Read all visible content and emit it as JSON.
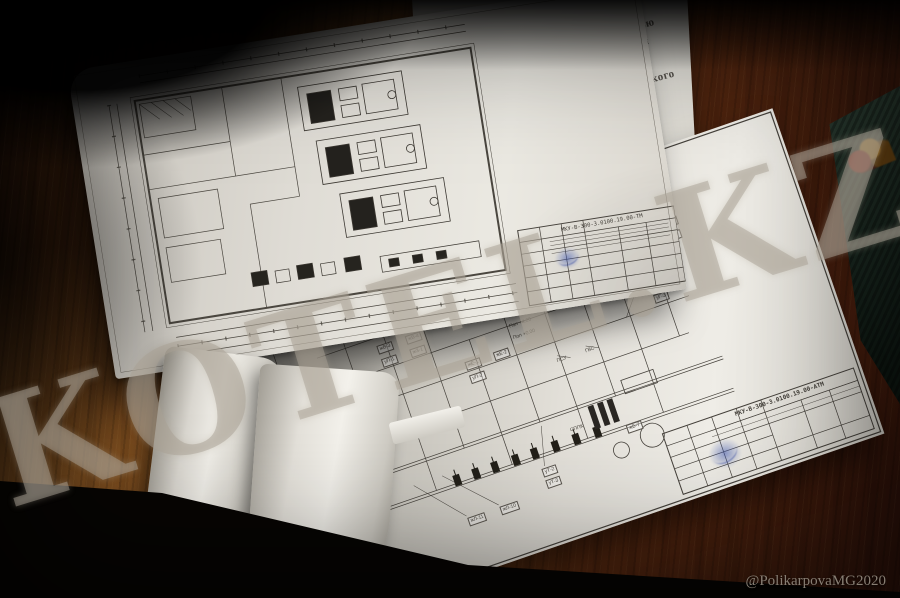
{
  "scene": {
    "watermark_text": "KOTEL.KZ",
    "credit_text": "@PolikarpovaMG2020",
    "colors": {
      "wood_light": "#7b4a1f",
      "wood_dark": "#2e120a",
      "paper": "#dcd9d2",
      "paper_shadow": "#a9a59c",
      "ink": "#45413b",
      "stamp_blue": "#3c55b0",
      "book_green": "#26352c",
      "watermark": "#aaa296"
    }
  },
  "under_page": {
    "fragments": [
      "щностью",
      "танция",
      "нического",
      "ние"
    ]
  },
  "upper_sheet": {
    "code": "МКУ-В-300-3.0100.19.00-ТМ"
  },
  "lower_sheet": {
    "code": "МКУ-В-300-3.0100.19.00-АТМ",
    "labels": [
      {
        "t": "жВ-1",
        "x": 26,
        "y": 148,
        "b": 1
      },
      {
        "t": "жВ-2",
        "x": 56,
        "y": 148,
        "b": 1
      },
      {
        "t": "жН-1",
        "x": 26,
        "y": 162,
        "b": 1
      },
      {
        "t": "жН-2",
        "x": 56,
        "y": 162,
        "b": 1
      },
      {
        "t": "уГ-1",
        "x": 34,
        "y": 190,
        "b": 1
      },
      {
        "t": "уГ-2",
        "x": 64,
        "y": 190,
        "b": 1
      },
      {
        "t": "жГ-3",
        "x": 34,
        "y": 204,
        "b": 1
      },
      {
        "t": "жВ-3",
        "x": 120,
        "y": 96,
        "b": 1
      },
      {
        "t": "жВ-4",
        "x": 150,
        "y": 96,
        "b": 1
      },
      {
        "t": "уП-1",
        "x": 120,
        "y": 110,
        "b": 1
      },
      {
        "t": "жЗ-1",
        "x": 150,
        "y": 110,
        "b": 1
      },
      {
        "t": "жЗ-2",
        "x": 182,
        "y": 74,
        "b": 1
      },
      {
        "t": "уТ-1",
        "x": 212,
        "y": 74,
        "b": 1
      },
      {
        "t": "жЕ-1",
        "x": 198,
        "y": 140,
        "b": 1
      },
      {
        "t": "жЕ-2",
        "x": 228,
        "y": 140,
        "b": 1
      },
      {
        "t": "уП-2",
        "x": 198,
        "y": 154,
        "b": 1
      },
      {
        "t": "Пол +4.20",
        "x": 252,
        "y": 118,
        "b": 0
      },
      {
        "t": "Пол +0.00",
        "x": 252,
        "y": 130,
        "b": 0
      },
      {
        "t": "ПСУ",
        "x": 286,
        "y": 166,
        "b": 0
      },
      {
        "t": "ГВС",
        "x": 316,
        "y": 166,
        "b": 0
      },
      {
        "t": "жЛ-11",
        "x": 150,
        "y": 288,
        "b": 1
      },
      {
        "t": "жЛ-10",
        "x": 184,
        "y": 288,
        "b": 1
      },
      {
        "t": "уТ-2",
        "x": 236,
        "y": 266,
        "b": 1
      },
      {
        "t": "уТ-3",
        "x": 236,
        "y": 278,
        "b": 1
      },
      {
        "t": "СППК",
        "x": 276,
        "y": 236,
        "b": 0
      },
      {
        "t": "жБ-7",
        "x": 330,
        "y": 252,
        "b": 1
      },
      {
        "t": "уП-3",
        "x": 398,
        "y": 96,
        "b": 1
      },
      {
        "t": "жН-3",
        "x": 398,
        "y": 110,
        "b": 1
      },
      {
        "t": "жВ-5",
        "x": 398,
        "y": 124,
        "b": 1
      },
      {
        "t": "уГ-3",
        "x": 398,
        "y": 138,
        "b": 1
      },
      {
        "t": "жЕ-3",
        "x": 430,
        "y": 70,
        "b": 1
      },
      {
        "t": "уТ-4",
        "x": 430,
        "y": 84,
        "b": 1
      },
      {
        "t": "жВ-6",
        "x": 300,
        "y": 52,
        "b": 1
      },
      {
        "t": "жЗ-3",
        "x": 330,
        "y": 52,
        "b": 1
      }
    ]
  }
}
